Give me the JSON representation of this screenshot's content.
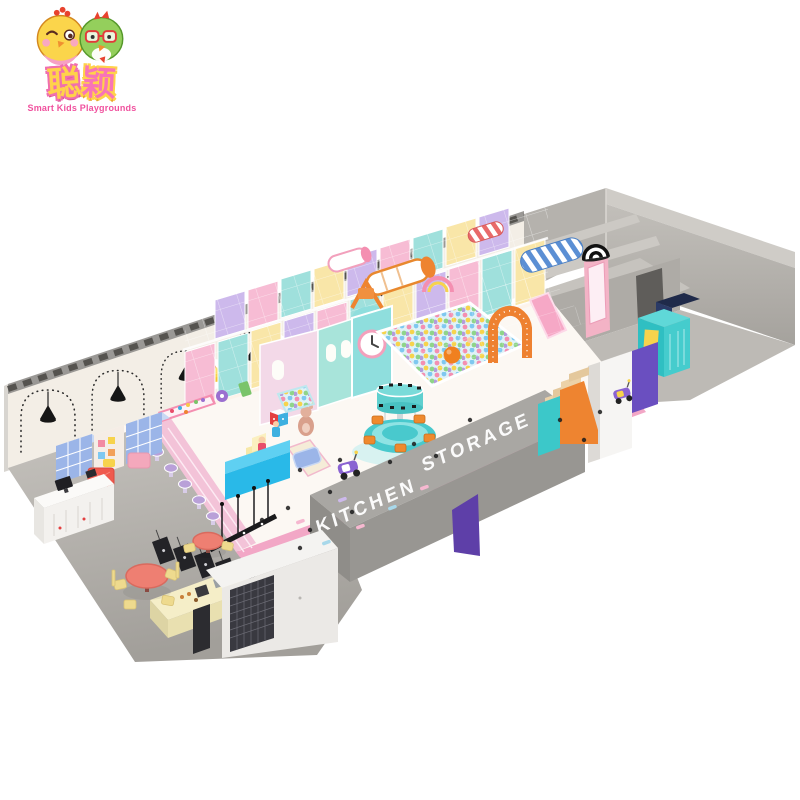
{
  "page": {
    "background": "#ffffff"
  },
  "logo": {
    "chinese_char1": "聪",
    "chinese_char2": "颖",
    "tagline": "Smart Kids Playgrounds",
    "mascots": [
      "yellow-chick-mascot",
      "green-bird-mascot"
    ]
  },
  "render": {
    "labels": {
      "kitchen": "KITCHEN",
      "storage": "STORAGE"
    },
    "palette": {
      "wall_cream": "#f3eee6",
      "rim_gray": "#8f8d89",
      "room_gray": "#b5b2ad",
      "floor_gray": "#b3b0ab",
      "box_gray": "#a9a7a3",
      "deck_ivory": "#fcf8f3",
      "pink": "#f6b8d0",
      "magenta": "#f2a7c6",
      "teal": "#49c9cd",
      "mint": "#9fe0dc",
      "yellow": "#f9e6a8",
      "orange": "#ee8430",
      "purple": "#6a4fc0",
      "blue": "#29b9e8",
      "coral": "#ee7f72",
      "lavender": "#cdb9ec"
    }
  }
}
